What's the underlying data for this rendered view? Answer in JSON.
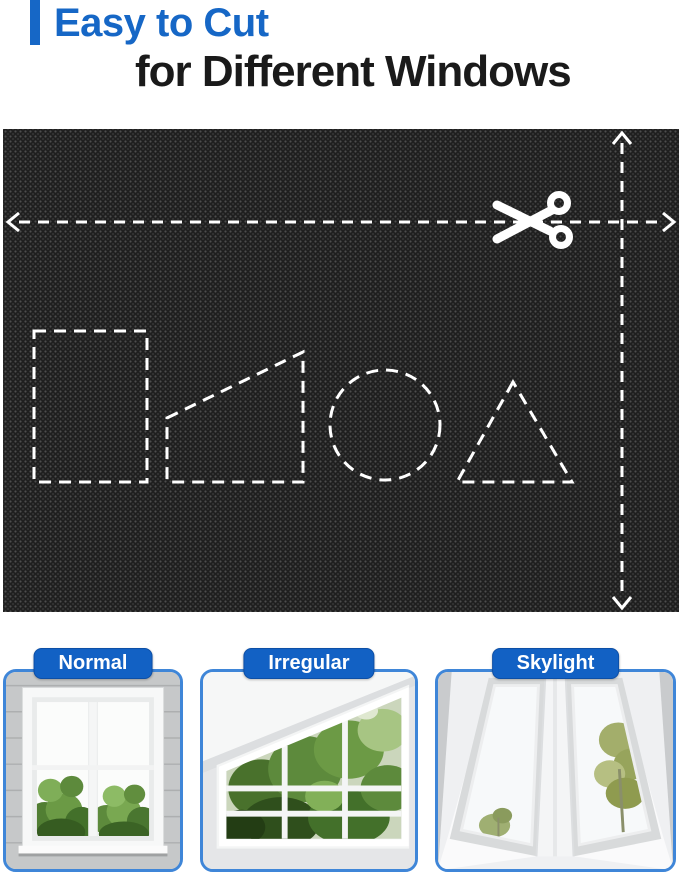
{
  "header": {
    "line1": "Easy to Cut",
    "line2": "for Different Windows"
  },
  "fabric_panel": {
    "icons": [
      "scissors-icon",
      "width-cut-arrow",
      "height-cut-arrow"
    ],
    "cut_shapes": [
      "rectangle",
      "right-trapezoid",
      "circle",
      "triangle"
    ]
  },
  "cards": [
    {
      "label": "Normal"
    },
    {
      "label": "Irregular"
    },
    {
      "label": "Skylight"
    }
  ],
  "colors": {
    "accent-blue": "#1667C6",
    "pill-blue": "#1261C4",
    "title-black": "#1A1A1A",
    "fabric-base": "#1F1F1F",
    "card-border": "#3F86D8",
    "dash-white": "#FFFFFF"
  }
}
